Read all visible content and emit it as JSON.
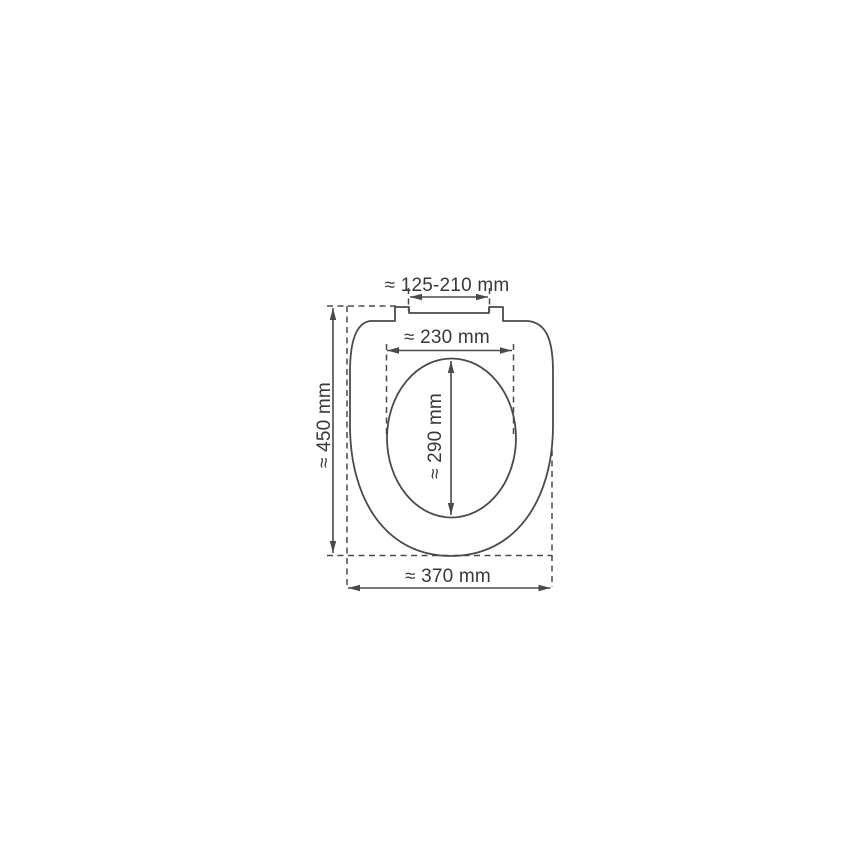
{
  "diagram": {
    "kind": "toilet-seat-top-view-dimension-drawing",
    "labels": {
      "hinge_spacing": "≈ 125-210 mm",
      "inner_width": "≈ 230 mm",
      "inner_length": "≈ 290 mm",
      "overall_length": "≈ 450 mm",
      "overall_width": "≈ 370 mm"
    },
    "colors": {
      "line": "#4a4a4a",
      "text": "#383838",
      "background": "#ffffff"
    }
  }
}
